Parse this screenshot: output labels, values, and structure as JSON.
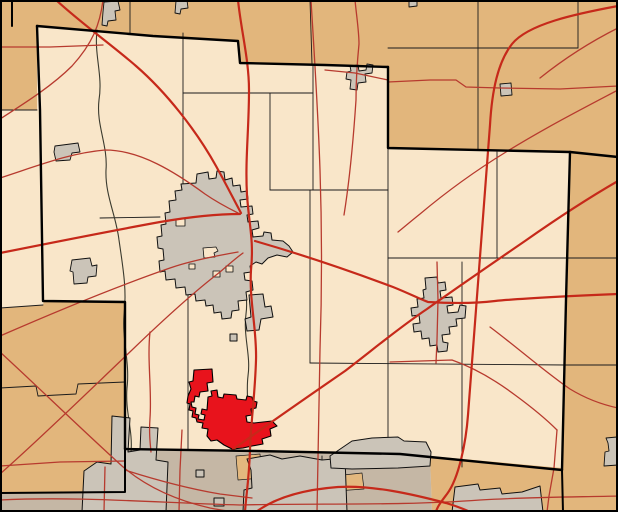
{
  "map": {
    "description": "county-highlight-locator-map",
    "canvas": {
      "width": 618,
      "height": 512
    },
    "colors": {
      "county_fill": "#F9E6C9",
      "adjacent_county_fill": "#E2B67C",
      "metro_area_fill": "#C5B7A5",
      "urban_area_fill": "#CBC4B8",
      "urban_outline": "#101010",
      "highlight_fill": "#E8131C",
      "highlight_outline": "#000000",
      "road_major": "#C6291A",
      "road_minor": "#B73A2E",
      "county_boundary": "#000000",
      "township_boundary": "#1B1B1B",
      "river": "#3A3A2E",
      "frame": "#000000"
    },
    "layers": [
      {
        "name": "county-base",
        "kind": "region",
        "fill": "#F9E6C9",
        "stroke": "none",
        "width": 0,
        "paths": [
          "M0,0 H618 V512 H0 Z"
        ]
      },
      {
        "name": "adjacent-county-north",
        "kind": "region",
        "fill": "#E2B67C",
        "stroke": "none",
        "width": 0,
        "paths": [
          "M0,0 H618 V156 L570,152 L388,148 L388,67 L325,65 L241,63 L238,41 L153,36 L37,26 L37,110 L0,110 Z"
        ]
      },
      {
        "name": "adjacent-county-west",
        "kind": "region",
        "fill": "#E2B67C",
        "stroke": "none",
        "width": 0,
        "paths": [
          "M0,308 L43,305 L44,301 L125,302 L125,492 L0,492 Z"
        ]
      },
      {
        "name": "adjacent-county-east",
        "kind": "region",
        "fill": "#E2B67C",
        "stroke": "none",
        "width": 0,
        "paths": [
          "M570,152 L618,156 V512 L563,512 L562,470 L566,300 Z"
        ]
      },
      {
        "name": "adjacent-county-southeast",
        "kind": "region",
        "fill": "#E2B67C",
        "stroke": "none",
        "width": 0,
        "paths": [
          "M430,456 L562,468 L563,512 L432,512 Z"
        ]
      },
      {
        "name": "metro-county-south",
        "kind": "region",
        "fill": "#C5B7A5",
        "stroke": "none",
        "width": 0,
        "paths": [
          "M125,450 L430,456 L432,512 L0,512 L0,492 L125,492 Z"
        ]
      },
      {
        "name": "metro-tan-patch",
        "kind": "region",
        "fill": "#E3B87E",
        "stroke": "#1B1B1B",
        "width": 0.7,
        "paths": [
          "M236,456 L260,454 L262,478 L238,480 Z",
          "M334,476 L362,473 L364,489 L336,491 Z"
        ]
      },
      {
        "name": "metro-cream-patch",
        "kind": "region",
        "fill": "#F9E6C9",
        "stroke": "#1B1B1B",
        "width": 0.7,
        "paths": [
          "M263,466 L286,465 L287,477 L264,478 Z"
        ]
      },
      {
        "name": "township-line",
        "kind": "line",
        "fill": "none",
        "stroke": "#1B1B1B",
        "width": 0.9,
        "paths": [
          "M0,110 L37,110",
          "M0,308 L43,305",
          "M130,0 L130,33",
          "M310,0 L312,64",
          "M478,0 L478,150",
          "M578,0 L578,48",
          "M388,48 L578,48",
          "M183,33 L183,187",
          "M270,93 L270,190",
          "M313,65 L313,190",
          "M183,93 L313,93",
          "M100,218 L160,217",
          "M270,190 L388,190",
          "M188,256 L188,449",
          "M310,190 L310,363",
          "M388,148 L388,452",
          "M462,262 L462,467",
          "M497,152 L497,258",
          "M388,258 L570,258",
          "M310,363 L566,365",
          "M570,258 L618,258",
          "M566,365 L618,365",
          "M0,388 L36,386 L38,396 L76,394 L78,384 L125,382",
          "M322,456 L322,512"
        ]
      },
      {
        "name": "river",
        "kind": "line",
        "fill": "none",
        "stroke": "#3A3A2E",
        "width": 1.1,
        "paths": [
          "M97,30 C94,55 103,75 99,100 C96,125 108,145 106,170 C105,195 116,215 119,240 C123,268 127,290 124,315 C122,340 130,362 127,388 C125,412 133,430 131,452",
          "M243,254 C240,274 249,292 246,314 C243,336 251,355 248,376 C246,392 249,404 247,416"
        ]
      },
      {
        "name": "urban-area-city-center",
        "kind": "urban",
        "fill": "#CBC4B8",
        "stroke": "#101010",
        "width": 1,
        "paths": [
          "M196,183 L197,174 L208,172 L209,179 L216,178 L217,171 L224,172 L225,180 L232,178 L233,186 L240,185 L241,192 L247,191 L248,199 L240,200 L241,207 L252,206 L253,214 L247,215 L248,222 L258,221 L259,228 L252,230 L253,237 L263,236 L264,232 L271,233 L272,240 L283,241 L289,246 L293,252 L287,257 L277,255 L268,258 L262,264 L256,262 L250,266 L251,272 L244,273 L245,280 L252,281 L253,290 L246,292 L247,300 L238,301 L239,310 L232,311 L231,318 L222,319 L221,312 L214,313 L213,305 L206,306 L205,300 L196,301 L195,294 L186,295 L185,287 L176,288 L175,279 L166,280 L165,271 L160,272 L159,261 L164,260 L163,249 L158,248 L157,237 L162,236 L161,225 L166,224 L165,213 L170,212 L169,201 L176,200 L175,191 L182,190 L181,184 Z"
        ]
      },
      {
        "name": "urban-area-city-south-fragment",
        "kind": "urban",
        "fill": "#CBC4B8",
        "stroke": "#101010",
        "width": 1,
        "paths": [
          "M249,295 L263,294 L265,307 L271,306 L273,317 L261,319 L259,330 L247,331 L245,319 L251,317 Z",
          "M230,334 h7 v7 h-7 Z"
        ]
      },
      {
        "name": "urban-enclave-hole",
        "kind": "urban",
        "fill": "#F9E6C9",
        "stroke": "#101010",
        "width": 0.8,
        "paths": [
          "M176,219 h9 v7 h-9 Z",
          "M203,248 l13,-1 2,4 -4,2 1,4 -11,1 Z",
          "M213,271 h7 v6 h-7 Z",
          "M226,266 h7 v6 h-7 Z",
          "M189,264 h6 v5 h-6 Z"
        ]
      },
      {
        "name": "urban-area-east-village",
        "kind": "urban",
        "fill": "#CBC4B8",
        "stroke": "#101010",
        "width": 1,
        "paths": [
          "M425,278 L437,277 L438,283 L445,282 L446,290 L440,291 L441,298 L452,297 L453,305 L447,306 L448,313 L458,312 L460,305 L466,306 L465,318 L456,319 L457,326 L449,327 L450,334 L442,335 L443,342 L448,343 L447,351 L438,352 L437,345 L430,346 L429,338 L422,339 L421,331 L414,332 L413,324 L420,323 L419,315 L412,316 L411,308 L418,307 L417,299 L424,298 L423,290 L426,289 Z"
        ]
      },
      {
        "name": "urban-area-small-village",
        "kind": "urban",
        "fill": "#CBC4B8",
        "stroke": "#101010",
        "width": 0.9,
        "paths": [
          "M104,2 L118,1 L120,10 L115,11 L116,20 L108,21 L107,26 L102,25 L103,12 Z",
          "M176,1 L187,0 L188,8 L181,9 L180,14 L175,13 Z",
          "M409,0 h8 v6 l-8,1 Z",
          "M350,66 L358,65 L359,71 L366,70 L367,64 L373,65 L372,73 L365,74 L366,82 L358,83 L357,90 L350,89 L351,80 L346,79 L347,72 L351,71 Z",
          "M500,84 L511,83 L512,95 L501,96 Z",
          "M55,146 L78,143 L80,152 L72,153 L70,160 L56,161 L54,152 Z",
          "M72,260 L90,258 L92,266 L97,265 L96,276 L88,277 L87,283 L74,284 L73,272 L70,271 Z",
          "M606,438 L617,437 L618,465 L604,466 L605,452 L609,451 L608,443 Z"
        ]
      },
      {
        "name": "urban-area-metro-west",
        "kind": "urban",
        "fill": "#CBC4B8",
        "stroke": "#101010",
        "width": 1,
        "paths": [
          "M84,471 L97,462 L111,464 L112,416 L130,418 L128,452 L140,450 L141,427 L158,428 L156,460 L168,462 L166,512 L82,512 Z"
        ]
      },
      {
        "name": "urban-area-metro-center",
        "kind": "urban",
        "fill": "#CBC4B8",
        "stroke": "#101010",
        "width": 1,
        "paths": [
          "M247,459 L270,455 L282,459 L300,456 L322,460 L345,458 L347,512 L243,512 L244,490 L252,488 L251,470 Z",
          "M196,470 h8 v7 h-8 Z",
          "M214,498 h10 v8 h-10 Z"
        ]
      },
      {
        "name": "urban-area-metro-right",
        "kind": "urban",
        "fill": "#CBC4B8",
        "stroke": "#101010",
        "width": 1,
        "paths": [
          "M330,456 L352,441 L372,438 L398,437 L404,441 L426,442 L431,452 L430,466 L398,468 L352,469 L331,468 Z",
          "M455,487 L478,484 L480,490 L500,488 L502,494 L522,492 L540,486 L543,512 L452,512 Z"
        ]
      },
      {
        "name": "highlighted-municipality",
        "kind": "highlight",
        "fill": "#E8131C",
        "stroke": "#000000",
        "width": 1.1,
        "paths": [
          "M194,370 L212,369 L213,382 L207,383 L208,391 L200,392 L199,397 L195,396 L194,402 L191,402 L192,407 L196,408 L195,414 L199,415 L198,419 L204,420 L205,415 L201,414 L202,409 L207,410 L208,397 L212,396 L211,391 L217,390 L218,397 L223,398 L224,394 L236,395 L237,399 L246,400 L247,396 L252,397 L253,401 L257,402 L256,408 L251,409 L252,415 L246,416 L247,422 L254,423 L263,422 L272,421 L277,426 L270,429 L271,436 L262,439 L263,444 L252,446 L243,448 L232,449 L224,445 L217,440 L211,441 L207,436 L208,429 L202,428 L203,423 L197,422 L196,418 L192,417 L193,411 L189,410 L190,404 L187,403 L188,396 L191,389 L189,382 L193,381 Z"
        ]
      },
      {
        "name": "road-minor",
        "kind": "road",
        "fill": "none",
        "stroke": "#B73A2E",
        "width": 1.3,
        "paths": [
          "M103,0 C100,25 92,44 72,66 C52,86 25,103 0,119",
          "M0,47 L50,47 L103,45",
          "M311,0 C314,50 318,110 320,170 C322,230 322,290 320,350 C319,400 318,455 317,512",
          "M618,90 C580,110 545,128 506,152 C475,171 445,193 420,214 C410,222 403,228 398,232",
          "M388,82 L430,80 L456,80 L466,87 L500,88 L560,89 L618,86",
          "M325,70 L355,73 L388,80",
          "M355,0 C357,20 359,32 359,44 C357,64 356,82 356,100 C352,160 348,190 344,215",
          "M0,178 C40,165 70,153 105,150 C140,150 175,172 205,194 C218,203 230,209 238,213",
          "M0,336 C55,312 115,287 170,268 C190,261 215,256 238,252",
          "M0,352 C35,384 80,428 122,466 C145,486 175,500 210,508 C225,511 235,512 242,512",
          "M0,474 C42,437 90,390 132,350 C160,323 190,295 220,272 C228,265 236,258 243,253",
          "M150,332 C147,360 152,390 150,418 C149,432 150,442 151,452",
          "M182,430 L180,470 L179,512",
          "M0,500 C80,496 160,503 240,505 C320,503 400,506 480,500 C530,497 580,497 618,496",
          "M490,327 C518,348 545,372 570,389 C588,400 604,405 618,408",
          "M390,362 L452,360 C475,368 495,380 515,395 C530,406 545,418 557,430",
          "M437,262 L438,300 L437,340 L436,363",
          "M557,430 L554,468 L549,496 L547,512",
          "M105,467 L104,512",
          "M0,466 L60,462 L125,461",
          "M125,470 C150,478 185,488 220,494 L252,498",
          "M618,28 C590,42 565,58 540,78"
        ]
      },
      {
        "name": "road-major",
        "kind": "road",
        "fill": "none",
        "stroke": "#C6291A",
        "width": 2.2,
        "paths": [
          "M238,0 C241,30 249,60 249,90 C249,130 245,160 247,195 C249,225 254,240 251,270 C249,300 257,330 256,360 C255,395 251,420 250,450 C249,480 246,496 245,512",
          "M618,6 C575,14 528,24 512,44 C498,62 492,90 490,125 C487,170 483,220 479,270 C475,320 471,370 468,415 C466,442 459,478 447,494 C441,502 437,507 436,512",
          "M56,0 C82,24 112,45 136,66 C166,92 196,130 216,166 C226,184 234,200 241,213",
          "M0,253 C50,243 105,232 160,222 C195,216 220,214 240,214",
          "M255,241 C300,254 345,269 393,287 C408,293 420,299 428,302 C445,303 470,304 495,301 C525,298 570,296 618,294",
          "M232,450 C260,430 300,402 345,371 C375,348 400,327 427,309 C455,289 490,265 525,241 C555,220 585,200 618,181",
          "M256,512 C272,500 298,490 338,487 C372,485 412,494 446,503 C456,506 464,509 470,512"
        ]
      },
      {
        "name": "county-boundary",
        "kind": "boundary",
        "fill": "none",
        "stroke": "#000000",
        "width": 2.4,
        "paths": [
          "M37,26 L153,36 L238,41 L240,63 L325,65 L388,67",
          "M388,67 L388,148 L570,152 L618,157",
          "M570,152 L566,300 L562,470",
          "M562,470 L430,457 L400,454 L255,451 L125,449",
          "M37,26 L40,110 L43,301 L125,302 L125,449"
        ]
      },
      {
        "name": "county-boundary-secondary",
        "kind": "boundary",
        "fill": "none",
        "stroke": "#000000",
        "width": 2,
        "paths": [
          "M125,449 L125,492 L0,493",
          "M12,0 L12,26",
          "M562,470 L563,512"
        ]
      },
      {
        "name": "map-frame-border",
        "kind": "frame",
        "fill": "none",
        "stroke": "#000000",
        "width": 4,
        "paths": [
          "M0,0 H618 V512 H0 Z"
        ]
      }
    ]
  }
}
